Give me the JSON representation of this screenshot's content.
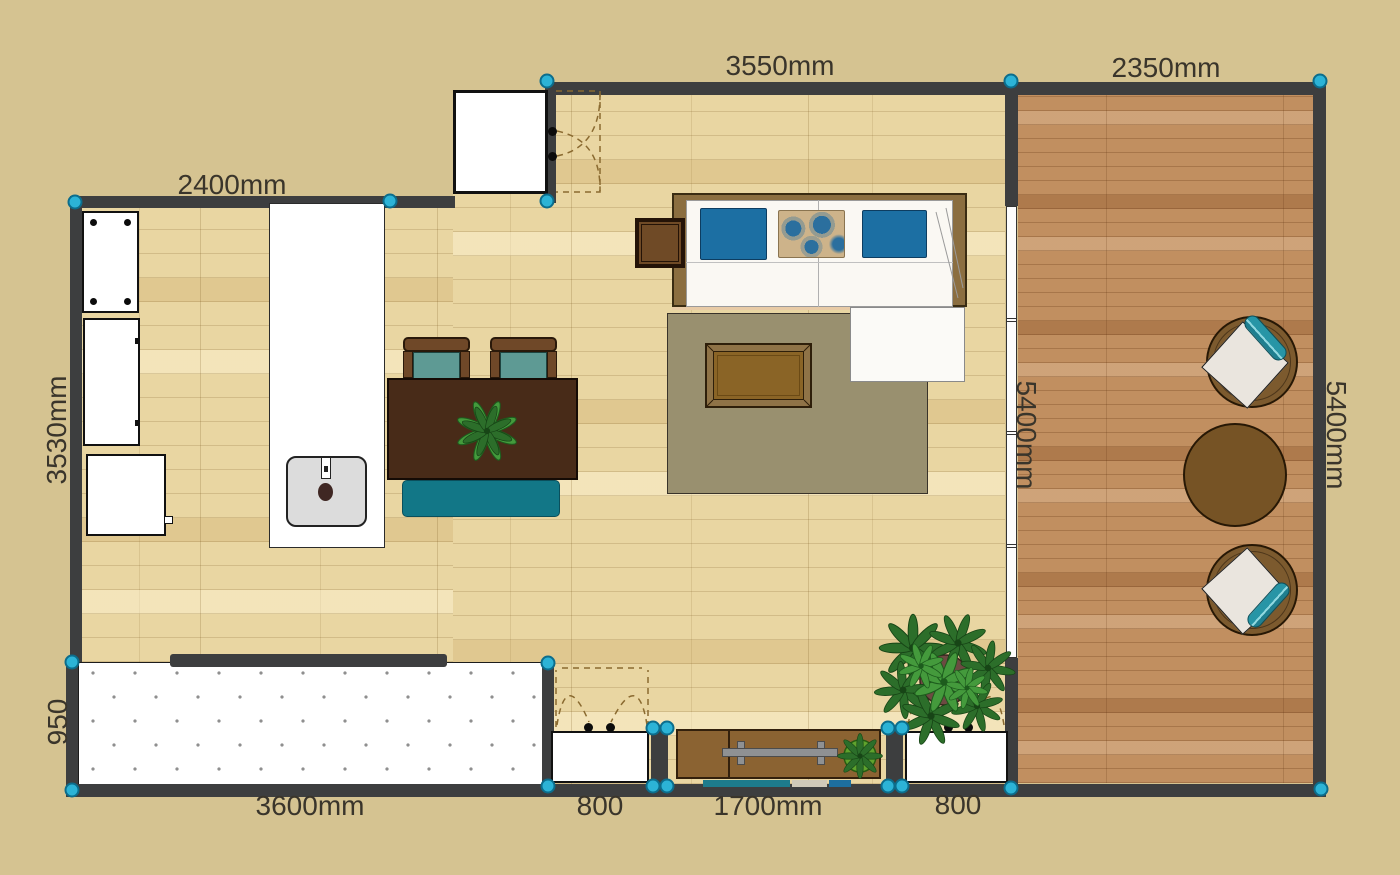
{
  "plan": {
    "dimension_labels": {
      "top_left": "2400mm",
      "top_middle": "3550mm",
      "top_right": "2350mm",
      "left_side": "3530mm",
      "balcony_depth": "950",
      "balcony_width": "3600mm",
      "left_door": "800",
      "sideboard": "1700mm",
      "right_door": "800",
      "inner_wall": "5400mm",
      "outer_right_wall": "5400mm"
    },
    "colors": {
      "background": "#d5c391",
      "wall": "#3d3e3f",
      "handle_accent": "#2cb3d6",
      "floor_living": "#e9d6a2",
      "floor_second_room": "#c18f60",
      "accent_teal": "#127787",
      "pillow_blue": "#1c6fa3",
      "rug": "#99906f"
    }
  }
}
